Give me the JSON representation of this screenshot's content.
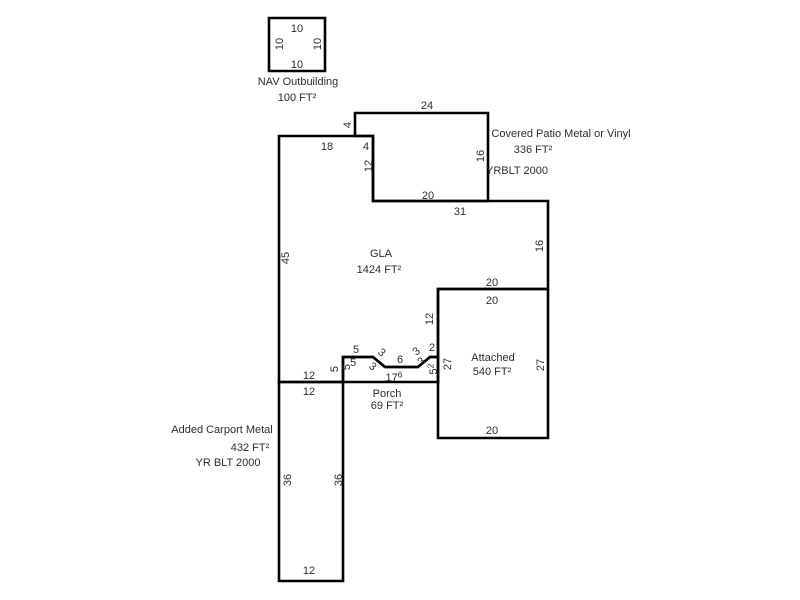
{
  "canvas": {
    "width": 800,
    "height": 600,
    "background": "#ffffff",
    "line_color": "#000000",
    "text_color": "#2d2d2d"
  },
  "structures": [
    {
      "name": "nav-outbuilding",
      "points": [
        [
          269,
          18
        ],
        [
          325,
          18
        ],
        [
          325,
          71
        ],
        [
          269,
          71
        ]
      ]
    },
    {
      "name": "covered-patio",
      "points": [
        [
          355,
          113
        ],
        [
          488,
          113
        ],
        [
          488,
          201
        ],
        [
          373,
          201
        ],
        [
          373,
          136
        ],
        [
          355,
          136
        ]
      ]
    },
    {
      "name": "gla",
      "points": [
        [
          279,
          136
        ],
        [
          373,
          136
        ],
        [
          373,
          201
        ],
        [
          548,
          201
        ],
        [
          548,
          289
        ],
        [
          438,
          289
        ],
        [
          438,
          357
        ],
        [
          430,
          357
        ],
        [
          418,
          367
        ],
        [
          385,
          367
        ],
        [
          373,
          357
        ],
        [
          343,
          357
        ],
        [
          343,
          382
        ],
        [
          279,
          382
        ]
      ]
    },
    {
      "name": "porch",
      "points": [
        [
          343,
          357
        ],
        [
          373,
          357
        ],
        [
          385,
          367
        ],
        [
          418,
          367
        ],
        [
          430,
          357
        ],
        [
          438,
          357
        ],
        [
          438,
          382
        ],
        [
          343,
          382
        ]
      ]
    },
    {
      "name": "attached-garage",
      "points": [
        [
          438,
          289
        ],
        [
          548,
          289
        ],
        [
          548,
          438
        ],
        [
          438,
          438
        ]
      ]
    },
    {
      "name": "added-carport",
      "points": [
        [
          279,
          382
        ],
        [
          343,
          382
        ],
        [
          343,
          581
        ],
        [
          279,
          581
        ]
      ]
    }
  ],
  "dimensions": [
    {
      "text": "10",
      "x": 297,
      "y": 28,
      "rot": 0
    },
    {
      "text": "10",
      "x": 279,
      "y": 44,
      "rot": -90
    },
    {
      "text": "10",
      "x": 317,
      "y": 44,
      "rot": -90
    },
    {
      "text": "10",
      "x": 297,
      "y": 64,
      "rot": 0
    },
    {
      "text": "24",
      "x": 427,
      "y": 105,
      "rot": 0
    },
    {
      "text": "4",
      "x": 347,
      "y": 125,
      "rot": -90
    },
    {
      "text": "16",
      "x": 480,
      "y": 156,
      "rot": -90
    },
    {
      "text": "18",
      "x": 327,
      "y": 146,
      "rot": 0
    },
    {
      "text": "4",
      "x": 366,
      "y": 146,
      "rot": 0
    },
    {
      "text": "12",
      "x": 368,
      "y": 166,
      "rot": -90
    },
    {
      "text": "20",
      "x": 428,
      "y": 195,
      "rot": 0
    },
    {
      "text": "31",
      "x": 460,
      "y": 211,
      "rot": 0
    },
    {
      "text": "16",
      "x": 539,
      "y": 246,
      "rot": -90
    },
    {
      "text": "45",
      "x": 285,
      "y": 258,
      "rot": -90
    },
    {
      "text": "20",
      "x": 492,
      "y": 282,
      "rot": 0
    },
    {
      "text": "12",
      "x": 429,
      "y": 319,
      "rot": -90
    },
    {
      "text": "5",
      "x": 356,
      "y": 349,
      "rot": 0
    },
    {
      "text": "5",
      "x": 353,
      "y": 362,
      "rot": 0
    },
    {
      "text": "5",
      "x": 334,
      "y": 369,
      "rot": -90
    },
    {
      "text": "5",
      "x": 346,
      "y": 367,
      "rot": -90
    },
    {
      "text": "3",
      "x": 382,
      "y": 352,
      "rot": 40
    },
    {
      "text": "3",
      "x": 373,
      "y": 366,
      "rot": 40
    },
    {
      "text": "6",
      "x": 400,
      "y": 359,
      "rot": 0
    },
    {
      "text": "3",
      "x": 416,
      "y": 351,
      "rot": -40
    },
    {
      "text": "3",
      "x": 421,
      "y": 361,
      "rot": -40
    },
    {
      "text": "2",
      "x": 432,
      "y": 347,
      "rot": 0
    },
    {
      "text": "5",
      "sup": "2",
      "x": 433,
      "y": 369,
      "rot": -90
    },
    {
      "text": "17",
      "sup": "6",
      "x": 394,
      "y": 377,
      "rot": 0
    },
    {
      "text": "20",
      "x": 492,
      "y": 300,
      "rot": 0
    },
    {
      "text": "27",
      "x": 447,
      "y": 364,
      "rot": -90
    },
    {
      "text": "27",
      "x": 540,
      "y": 365,
      "rot": -90
    },
    {
      "text": "20",
      "x": 492,
      "y": 430,
      "rot": 0
    },
    {
      "text": "12",
      "x": 309,
      "y": 375,
      "rot": 0
    },
    {
      "text": "12",
      "x": 309,
      "y": 391,
      "rot": 0
    },
    {
      "text": "36",
      "x": 287,
      "y": 480,
      "rot": -90
    },
    {
      "text": "36",
      "x": 338,
      "y": 480,
      "rot": -90
    },
    {
      "text": "12",
      "x": 309,
      "y": 570,
      "rot": 0
    }
  ],
  "annotations": [
    {
      "text": "NAV Outbuilding",
      "x": 298,
      "y": 81
    },
    {
      "text": "100 FT²",
      "x": 297,
      "y": 97
    },
    {
      "text": "Covered Patio Metal or Vinyl",
      "x": 561,
      "y": 133
    },
    {
      "text": "336 FT²",
      "x": 533,
      "y": 149
    },
    {
      "text": "YRBLT 2000",
      "x": 517,
      "y": 170
    },
    {
      "text": "GLA",
      "x": 381,
      "y": 253
    },
    {
      "text": "1424 FT²",
      "x": 379,
      "y": 269
    },
    {
      "text": "Attached",
      "x": 493,
      "y": 357
    },
    {
      "text": "540 FT²",
      "x": 492,
      "y": 371
    },
    {
      "text": "Porch",
      "x": 387,
      "y": 393
    },
    {
      "text": "69 FT²",
      "x": 387,
      "y": 405
    },
    {
      "text": "Added Carport Metal",
      "x": 222,
      "y": 429
    },
    {
      "text": "432 FT²",
      "x": 250,
      "y": 447
    },
    {
      "text": "YR BLT 2000",
      "x": 228,
      "y": 462
    }
  ]
}
